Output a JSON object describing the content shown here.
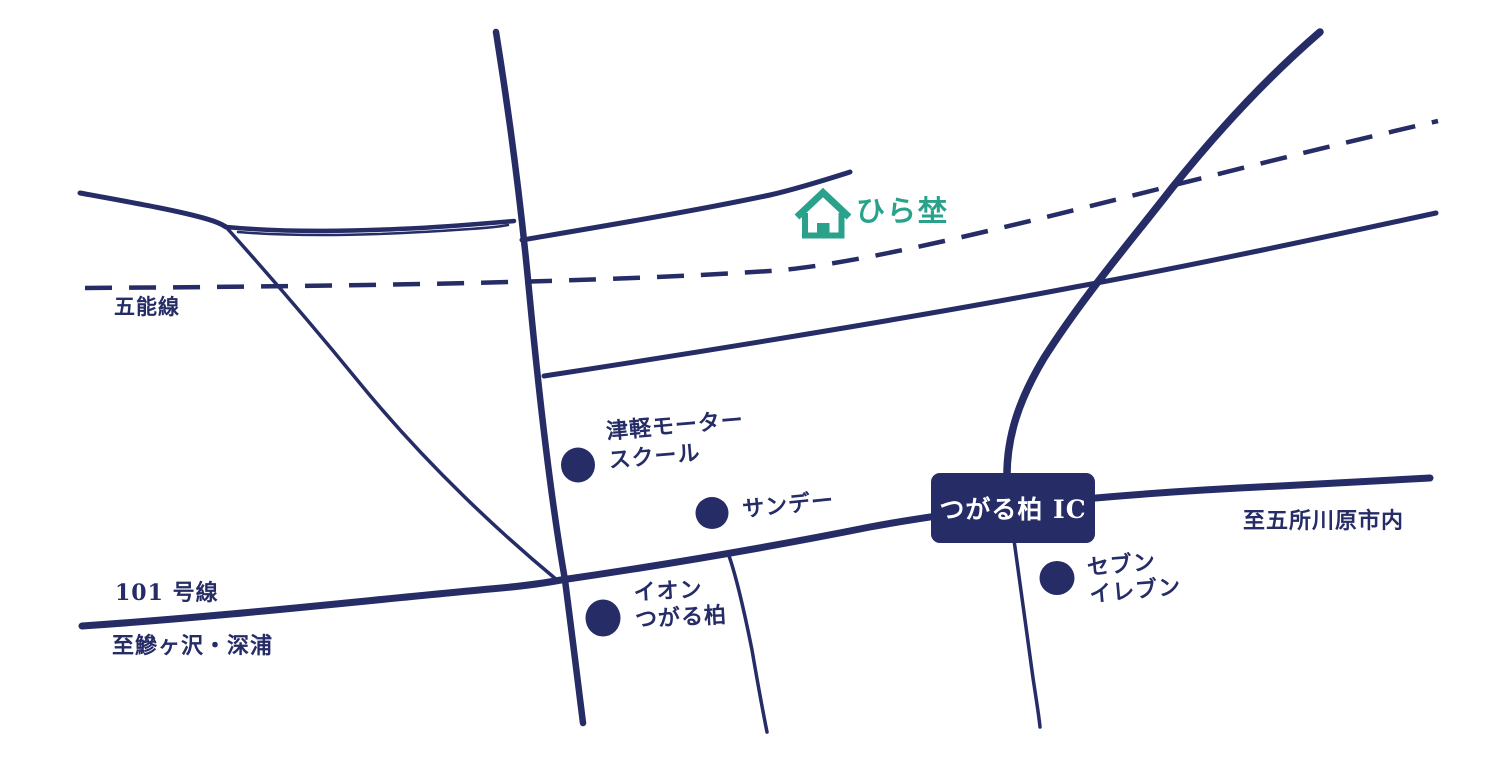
{
  "colors": {
    "navy": "#252c66",
    "teal": "#2aa28b",
    "white": "#ffffff"
  },
  "destination": {
    "name": "ひら埜"
  },
  "labels": {
    "railway": "五能線",
    "route_number": "101 号線",
    "toward_southwest": "至鰺ヶ沢・深浦",
    "toward_northeast": "至五所川原市内",
    "interchange": "つがる柏 IC"
  },
  "pois": [
    {
      "id": "tsugaru-motor-school",
      "line1": "津軽モーター",
      "line2": "スクール"
    },
    {
      "id": "sunday",
      "line1": "サンデー",
      "line2": ""
    },
    {
      "id": "aeon-tsugaru-kashiwa",
      "line1": "イオン",
      "line2": "つがる柏"
    },
    {
      "id": "seven-eleven",
      "line1": "セブン",
      "line2": "イレブン"
    }
  ]
}
